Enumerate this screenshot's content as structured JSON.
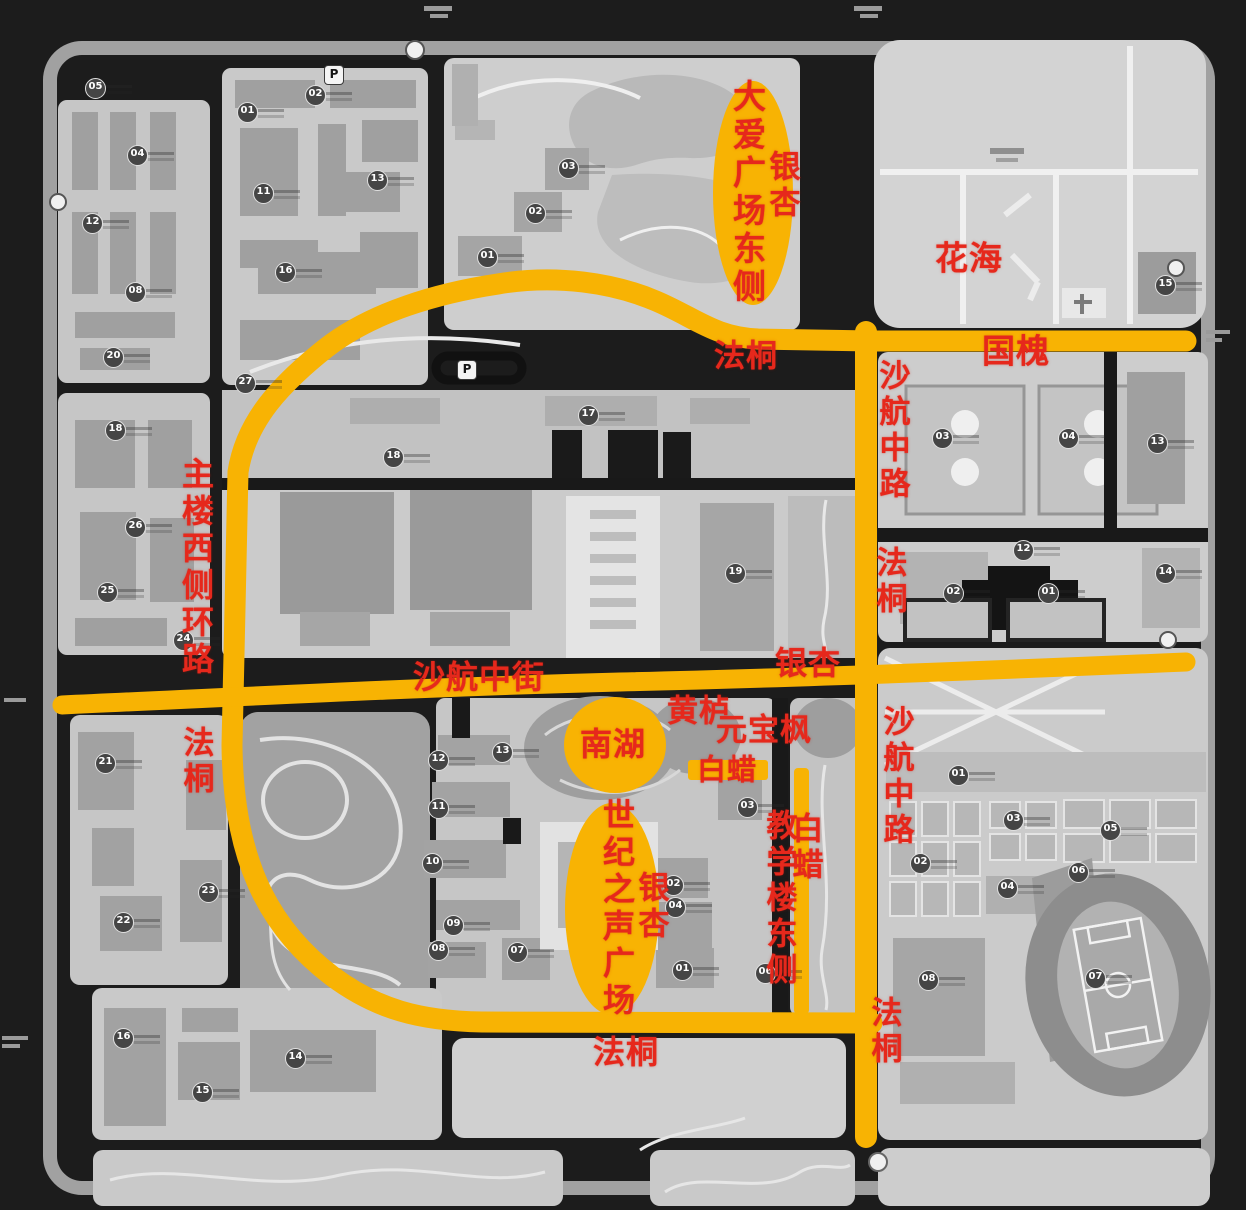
{
  "colors": {
    "background": "#1c1c1c",
    "road_highlight": "#f8b303",
    "label_red": "#e6281c"
  },
  "road_labels": {
    "daai_square_east": "大爱广场东侧",
    "ginkgo_top": "银杏",
    "flower_sea": "花海",
    "plane_tree_top": "法桐",
    "pagoda_tree_top": "国槐",
    "shahang_middle_road_upper": "沙航中路",
    "plane_tree_right_upper": "法桐",
    "main_building_west_ring_road": "主楼西侧环路",
    "plane_tree_left": "法桐",
    "shahang_middle_street": "沙航中街",
    "ginkgo_middle": "银杏",
    "smoke_tree": "黄栌",
    "shantung_maple": "元宝枫",
    "south_lake": "南湖",
    "ash_tree_horizontal": "白蜡",
    "century_voice_plaza": "世纪之声广场",
    "ginkgo_plaza": "银杏",
    "teaching_building_east": "教学楼东侧",
    "ash_tree_vertical": "白蜡",
    "shahang_middle_road_lower": "沙航中路",
    "plane_tree_right_lower": "法桐",
    "plane_tree_bottom": "法桐"
  },
  "parking_icons": {
    "letter": "P",
    "positions": [
      {
        "x": 333,
        "y": 74
      },
      {
        "x": 466,
        "y": 369
      }
    ]
  },
  "building_markers": [
    {
      "n": "05",
      "x": 95,
      "y": 88
    },
    {
      "n": "02",
      "x": 315,
      "y": 95
    },
    {
      "n": "01",
      "x": 247,
      "y": 112
    },
    {
      "n": "04",
      "x": 137,
      "y": 155
    },
    {
      "n": "13",
      "x": 377,
      "y": 180
    },
    {
      "n": "11",
      "x": 263,
      "y": 193
    },
    {
      "n": "12",
      "x": 92,
      "y": 223
    },
    {
      "n": "16",
      "x": 285,
      "y": 272
    },
    {
      "n": "08",
      "x": 135,
      "y": 292
    },
    {
      "n": "20",
      "x": 113,
      "y": 357
    },
    {
      "n": "03",
      "x": 568,
      "y": 168
    },
    {
      "n": "02",
      "x": 535,
      "y": 213
    },
    {
      "n": "01",
      "x": 487,
      "y": 257
    },
    {
      "n": "15",
      "x": 1165,
      "y": 285
    },
    {
      "n": "27",
      "x": 245,
      "y": 383
    },
    {
      "n": "17",
      "x": 588,
      "y": 415
    },
    {
      "n": "18",
      "x": 393,
      "y": 457
    },
    {
      "n": "18",
      "x": 115,
      "y": 430
    },
    {
      "n": "19",
      "x": 735,
      "y": 573
    },
    {
      "n": "03",
      "x": 942,
      "y": 438
    },
    {
      "n": "04",
      "x": 1068,
      "y": 438
    },
    {
      "n": "13",
      "x": 1157,
      "y": 443
    },
    {
      "n": "12",
      "x": 1023,
      "y": 550
    },
    {
      "n": "14",
      "x": 1165,
      "y": 573
    },
    {
      "n": "02",
      "x": 953,
      "y": 593
    },
    {
      "n": "01",
      "x": 1048,
      "y": 593
    },
    {
      "n": "26",
      "x": 135,
      "y": 527
    },
    {
      "n": "25",
      "x": 107,
      "y": 592
    },
    {
      "n": "24",
      "x": 183,
      "y": 640
    },
    {
      "n": "21",
      "x": 105,
      "y": 763
    },
    {
      "n": "23",
      "x": 208,
      "y": 892
    },
    {
      "n": "22",
      "x": 123,
      "y": 922
    },
    {
      "n": "12",
      "x": 438,
      "y": 760
    },
    {
      "n": "13",
      "x": 502,
      "y": 752
    },
    {
      "n": "11",
      "x": 438,
      "y": 808
    },
    {
      "n": "10",
      "x": 432,
      "y": 863
    },
    {
      "n": "09",
      "x": 453,
      "y": 925
    },
    {
      "n": "08",
      "x": 438,
      "y": 950
    },
    {
      "n": "07",
      "x": 517,
      "y": 952
    },
    {
      "n": "03",
      "x": 747,
      "y": 807
    },
    {
      "n": "02",
      "x": 673,
      "y": 885
    },
    {
      "n": "04",
      "x": 675,
      "y": 907
    },
    {
      "n": "01",
      "x": 682,
      "y": 970
    },
    {
      "n": "06",
      "x": 765,
      "y": 973
    },
    {
      "n": "01",
      "x": 958,
      "y": 775
    },
    {
      "n": "03",
      "x": 1013,
      "y": 820
    },
    {
      "n": "05",
      "x": 1110,
      "y": 830
    },
    {
      "n": "02",
      "x": 920,
      "y": 863
    },
    {
      "n": "06",
      "x": 1078,
      "y": 872
    },
    {
      "n": "04",
      "x": 1007,
      "y": 888
    },
    {
      "n": "08",
      "x": 928,
      "y": 980
    },
    {
      "n": "07",
      "x": 1095,
      "y": 978
    },
    {
      "n": "16",
      "x": 123,
      "y": 1038
    },
    {
      "n": "14",
      "x": 295,
      "y": 1058
    },
    {
      "n": "15",
      "x": 202,
      "y": 1092
    }
  ]
}
